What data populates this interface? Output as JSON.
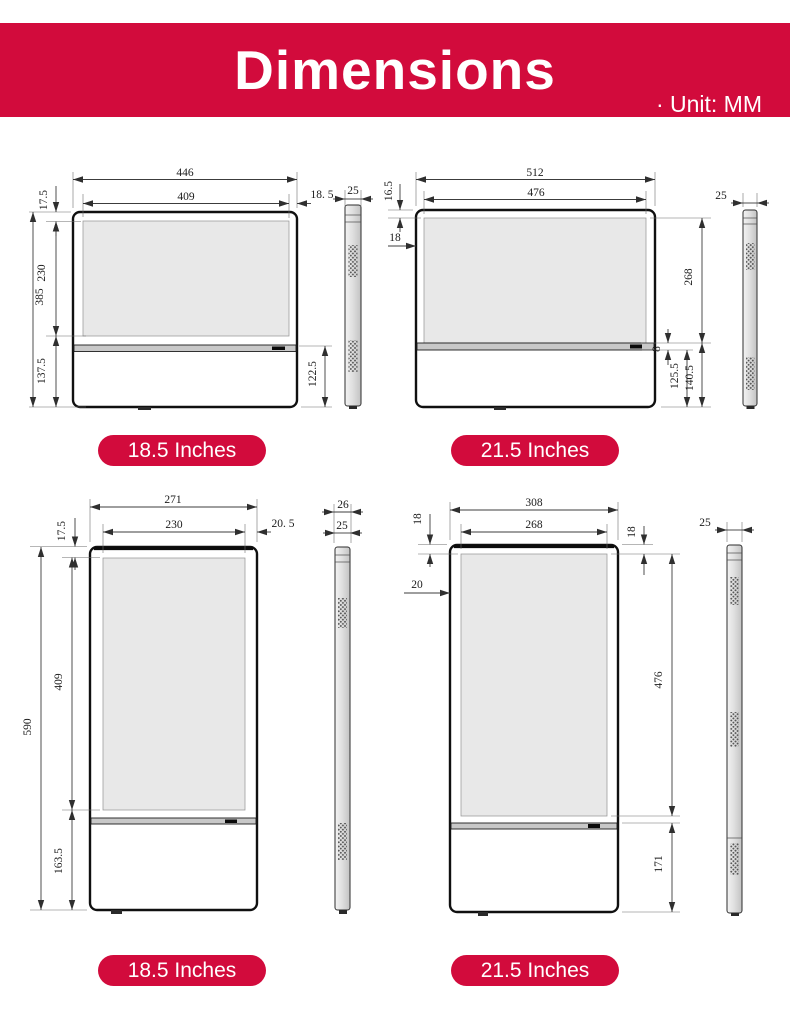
{
  "header": {
    "title": "Dimensions",
    "unit_label": "· Unit: MM",
    "background_color": "#d20b3c",
    "text_color": "#ffffff"
  },
  "colors": {
    "accent_red": "#d20b3c",
    "screen_fill": "#e8e8e8",
    "dimension_line": "#3c3c3c"
  },
  "drawings": [
    {
      "name": "18.5-inch landscape front and side view",
      "badge": "18.5 Inches",
      "dims": {
        "overall_width": "446",
        "screen_width": "409",
        "side_margin": "18. 5",
        "depth": "25",
        "top_margin": "17.5",
        "screen_height": "230",
        "base_height": "137.5",
        "overall_height": "385",
        "base_right_height": "122.5"
      }
    },
    {
      "name": "21.5-inch landscape front and side view",
      "badge": "21.5 Inches",
      "dims": {
        "overall_width": "512",
        "screen_width": "476",
        "top_margin": "16.5",
        "left_margin": "18",
        "screen_height": "268",
        "divider_height": "8",
        "base_inner_height": "125.5",
        "base_outer_height": "140.5",
        "depth": "25"
      }
    },
    {
      "name": "18.5-inch portrait front and side view",
      "badge": "18.5 Inches",
      "dims": {
        "overall_width": "271",
        "screen_width": "230",
        "side_margin": "20. 5",
        "top_margin": "17.5",
        "screen_height": "409",
        "overall_height": "590",
        "base_height": "163.5",
        "depth_outer": "26",
        "depth": "25"
      }
    },
    {
      "name": "21.5-inch portrait front and side view",
      "badge": "21.5 Inches",
      "dims": {
        "overall_width": "308",
        "screen_width": "268",
        "top_margin_left": "18",
        "top_margin_right": "18",
        "left_margin": "20",
        "screen_height": "476",
        "base_height": "171",
        "depth": "25"
      }
    }
  ]
}
